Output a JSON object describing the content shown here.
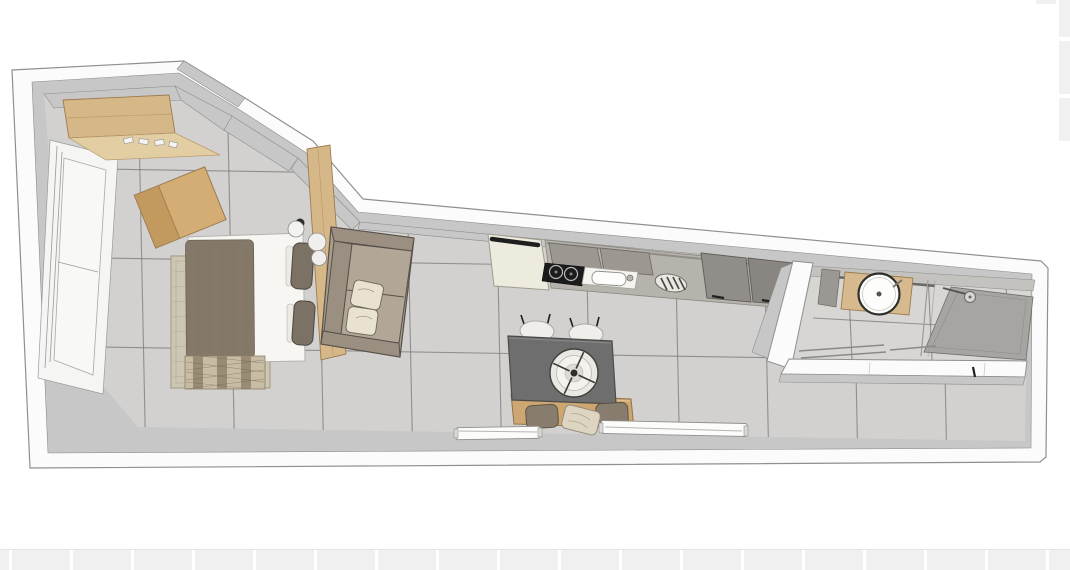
{
  "scene": {
    "title": "Studio apartment 3D floor plan, top-down view",
    "style": "sketchup-like architectural render on white canvas with faint background grid",
    "rooms": [
      {
        "name": "bedroom",
        "position": "left",
        "furniture": [
          "wardrobe-with-shoes",
          "casement-window",
          "angled-desk",
          "double-bed",
          "brown-blanket",
          "two-dark-pillows",
          "beige-rug",
          "patterned-throw",
          "wood-divider-panel",
          "round-wall-lamps"
        ]
      },
      {
        "name": "living-area",
        "position": "center-left",
        "furniture": [
          "two-seat-sofa",
          "two-cream-pillows"
        ]
      },
      {
        "name": "kitchen",
        "position": "top-center",
        "furniture": [
          "fridge-with-black-handle",
          "wall-cabinets",
          "induction-cooktop",
          "sink-with-faucet",
          "dish-drainer",
          "two-tall-cabinets"
        ]
      },
      {
        "name": "dining-area",
        "position": "center",
        "furniture": [
          "dark-gray-table",
          "decor-plate",
          "two-white-chairs",
          "wood-bench",
          "three-bench-cushions",
          "two-floor-convectors"
        ]
      },
      {
        "name": "bathroom",
        "position": "right",
        "furniture": [
          "wood-vanity",
          "round-sink",
          "shower-tray",
          "shower-head",
          "glass-partition",
          "towel-rails",
          "appliance-block",
          "door-handle"
        ]
      }
    ],
    "counts": {
      "chairs": 2,
      "bed-pillows": 2,
      "sofa-pillows": 2,
      "bench-cushions": 3,
      "convectors": 2,
      "tall-cabinets": 2,
      "burners": 2
    }
  },
  "palette": {
    "canvas": "#ffffff",
    "grid-cell": "#f0f0f0",
    "grid-gap": "#ffffff",
    "wall-outer": "#fbfbfb",
    "wall-stroke": "#8f8f8f",
    "wall-face": "#c7c7c7",
    "wall-face-stroke": "#8c8c8a",
    "floor": "#d2d1cf",
    "floor-bath": "#d7d6d3",
    "grout": "#7a7977",
    "wood": "#d6b888",
    "wood-light": "#e3cda3",
    "wood-dark": "#c29a5f",
    "wood-stroke": "#9c7c50",
    "blanket": "#847968",
    "sheet": "#f7f6f3",
    "pillow-dark": "#7b7165",
    "rug": "#cec6b4",
    "rug-border": "#b0a790",
    "throw-light": "#c8bda4",
    "throw-dark": "#998b74",
    "sofa": "#a89d8d",
    "sofa-cushion": "#b2a797",
    "sofa-arm": "#9a8f80",
    "sofa-stroke": "#57514a",
    "pillow-cream": "#e9e2d1",
    "counter": "#b6b2ac",
    "cabinet": "#9c9791",
    "cabinet-dark": "#8c8882",
    "fridge": "#edeade",
    "handle": "#1e1e1e",
    "cooktop": "#1b1b1b",
    "burner": "#b9b9b9",
    "sink": "#f4f3f0",
    "table": "#6e6e6e",
    "table-stroke": "#4b4b4b",
    "chair": "#efeeea",
    "chair-leg": "#1f1f1f",
    "bench": "#cda671",
    "bench-pillow": "#877c6e",
    "plate": "#eae8e2",
    "plate-stroke": "#3e3e3c",
    "shower": "#a7a5a1",
    "fixture": "#55534f",
    "glass": "#9a9a98"
  }
}
